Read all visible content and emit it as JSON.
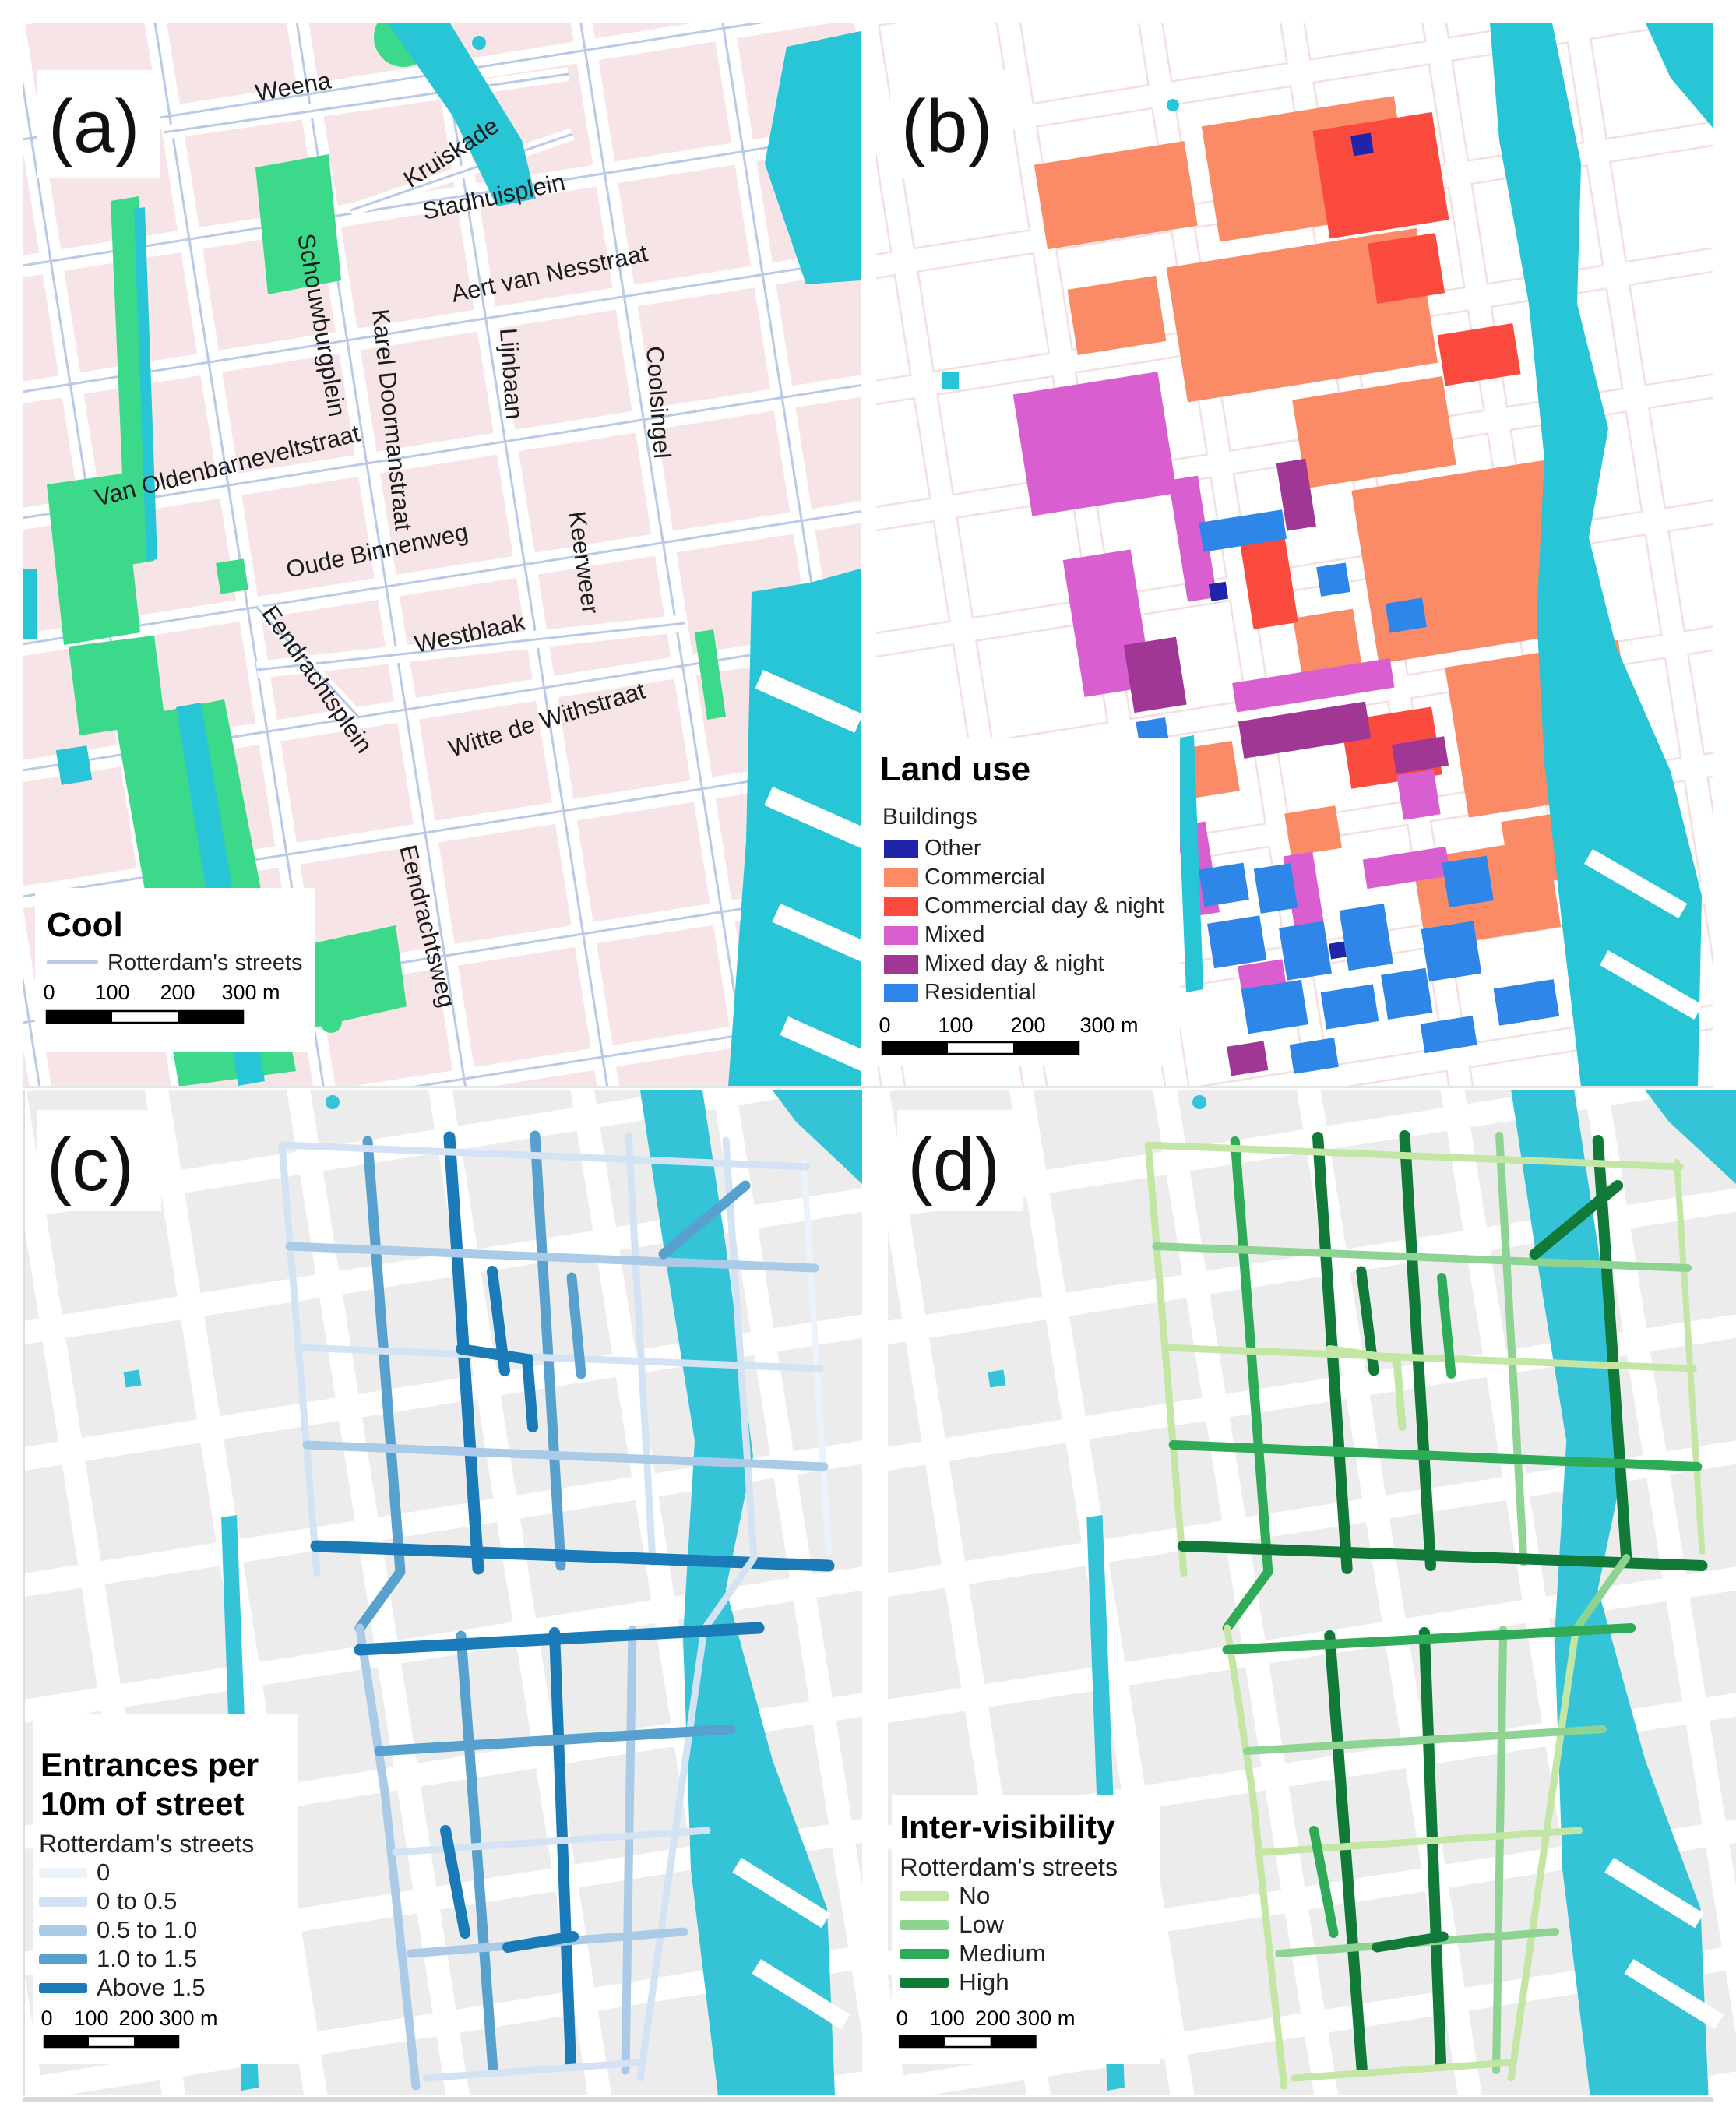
{
  "colors": {
    "water": "#27C5D6",
    "park": "#3CD98B",
    "building_pink": "#F7E4E6",
    "building_grey": "#ECECEC",
    "street_line": "#B9C9E7"
  },
  "panel_a": {
    "letter": "(a)",
    "legend": {
      "title": "Cool",
      "streets_label": "Rotterdam's streets",
      "street_line_color": "#B9C9E7"
    },
    "street_labels": [
      "Weena",
      "Kruiskade",
      "Stadhuisplein",
      "Aert van Nesstraat",
      "Schouwburgplein",
      "Karel Doormanstraat",
      "Lijnbaan",
      "Coolsingel",
      "Van Oldenbarneveltstraat",
      "Oude Binnenweg",
      "Keerweer",
      "Westblaak",
      "Eendrachtsplein",
      "Witte de Withstraat",
      "Eendrachtsweg"
    ],
    "scale_ticks": [
      "0",
      "100",
      "200",
      "300 m"
    ]
  },
  "panel_b": {
    "letter": "(b)",
    "legend": {
      "title": "Land use",
      "subtitle": "Buildings",
      "classes": [
        {
          "label": "Other",
          "color": "#1F24A8"
        },
        {
          "label": "Commercial",
          "color": "#FB8A66"
        },
        {
          "label": "Commercial day & night",
          "color": "#FB4B3E"
        },
        {
          "label": "Mixed",
          "color": "#D95FD0"
        },
        {
          "label": "Mixed day & night",
          "color": "#A03795"
        },
        {
          "label": "Residential",
          "color": "#2E86E8"
        }
      ]
    },
    "scale_ticks": [
      "0",
      "100",
      "200",
      "300 m"
    ]
  },
  "panel_c": {
    "letter": "(c)",
    "legend": {
      "title_line1": "Entrances per",
      "title_line2": "10m of street",
      "streets_label": "Rotterdam's streets",
      "classes": [
        {
          "label": "0",
          "color": "#EDF3FA"
        },
        {
          "label": "0 to 0.5",
          "color": "#D3E3F4"
        },
        {
          "label": "0.5 to 1.0",
          "color": "#A9CBE7"
        },
        {
          "label": "1.0 to 1.5",
          "color": "#58A1CF"
        },
        {
          "label": "Above 1.5",
          "color": "#1B7AB8"
        }
      ]
    },
    "scale_ticks": [
      "0",
      "100",
      "200",
      "300 m"
    ]
  },
  "panel_d": {
    "letter": "(d)",
    "legend": {
      "title": "Inter-visibility",
      "streets_label": "Rotterdam's streets",
      "classes": [
        {
          "label": "No",
          "color": "#C4E6A4"
        },
        {
          "label": "Low",
          "color": "#8FD392"
        },
        {
          "label": "Medium",
          "color": "#2FAB58"
        },
        {
          "label": "High",
          "color": "#117A38"
        }
      ]
    },
    "scale_ticks": [
      "0",
      "100",
      "200",
      "300 m"
    ]
  }
}
